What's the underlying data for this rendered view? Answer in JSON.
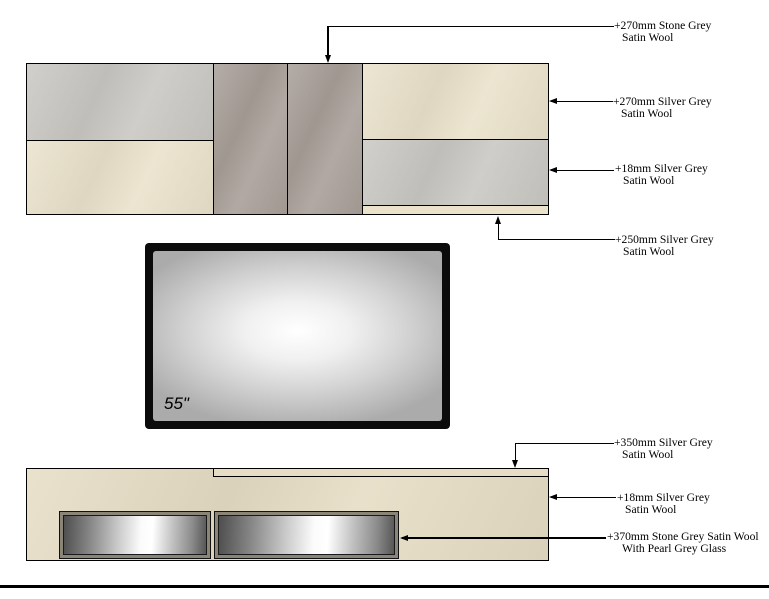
{
  "drawing": {
    "tv": {
      "size_label": "55\""
    },
    "callouts": [
      {
        "line1": "+270mm Stone Grey",
        "line2": "Satin Wool"
      },
      {
        "line1": "+270mm Silver Grey",
        "line2": "Satin Wool"
      },
      {
        "line1": "+18mm Silver Grey",
        "line2": "Satin Wool"
      },
      {
        "line1": "+250mm Silver Grey",
        "line2": "Satin Wool"
      },
      {
        "line1": "+350mm Silver Grey",
        "line2": "Satin Wool"
      },
      {
        "line1": "+18mm Silver Grey",
        "line2": "Satin Wool"
      },
      {
        "line1": "+370mm Stone Grey Satin Wool",
        "line2": "With Pearl Grey Glass"
      }
    ]
  },
  "colors": {
    "background": "#ffffff",
    "line_black": "#000000",
    "cream_satin_wool": "#eae2cb",
    "cream_satin_wool_deep": "#e6ddc4",
    "silver_grey_satin_wool": "#cac8c3",
    "stone_grey_satin_wool": "#a89f98",
    "door_frame_grey": "#8b8577",
    "glass_pearl_white": "#ffffff",
    "glass_shadow_grey": "#4f4f4f",
    "tv_frame_black": "#0b0b0b"
  }
}
